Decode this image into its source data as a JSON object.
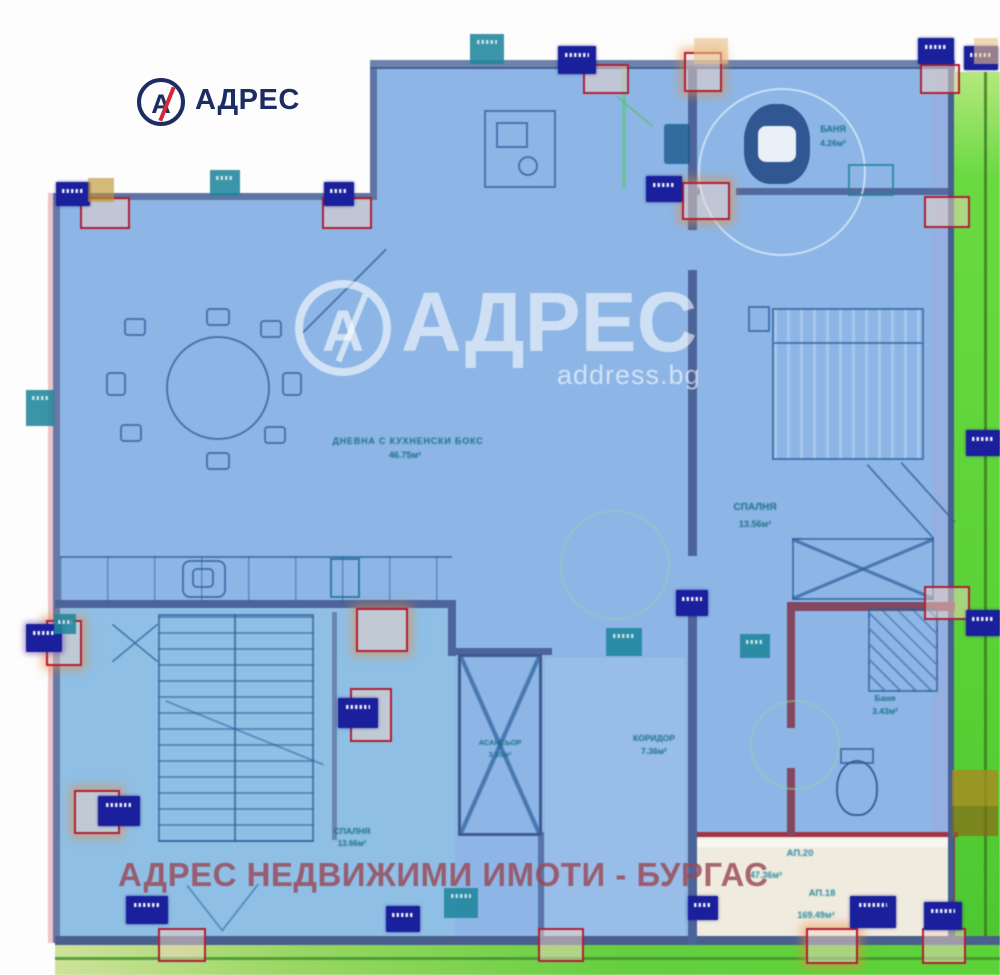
{
  "branding": {
    "logo": {
      "mark": "А",
      "text": "АДРЕС"
    },
    "watermark": {
      "mark": "А",
      "title": "АДРЕС",
      "site": "address.bg"
    },
    "footer_watermark": "АДРЕС НЕДВИЖИМИ ИМОТИ - БУРГАС"
  },
  "floorplan": {
    "rooms": {
      "living": {
        "label": "ДНЕВНА С КУХНЕНСКИ БОКС",
        "area": "46.75м²"
      },
      "bedroom_right": {
        "label": "СПАЛНЯ",
        "area": "13.56м²"
      },
      "bathroom_top": {
        "label": "БАНЯ",
        "area": "4.26м²"
      },
      "corridor": {
        "label": "КОРИДОР",
        "area": "7.36м²"
      },
      "elevator": {
        "label": "АСАНСЬОР",
        "area": "3.20м²"
      },
      "bedroom_left": {
        "label": "СПАЛНЯ",
        "area": "13.66м²"
      },
      "bathroom_bottom": {
        "label": "Баня",
        "area": "3.43м²"
      }
    },
    "apartments": {
      "ap20": {
        "label": "АП.20",
        "area": "47.36м²"
      },
      "ap18": {
        "label": "АП.18",
        "area": "169.49м²"
      }
    },
    "icons": {
      "dining_table": "circle-with-chairs",
      "bed": "striped-rect",
      "toilet": "rounded-blob",
      "shower": "hatched-square",
      "stairs": "stepped-rect",
      "elevator": "x-crossed-rect",
      "sink": "double-ellipse"
    },
    "colors": {
      "fill": "#8db6e6",
      "wall": "#4d649a",
      "column": "#b01f35",
      "marker": "#1a1f9c",
      "label": "#1a7087",
      "terrace_green": "#62d83e",
      "apartment_bg": "#f0ebdf",
      "footer_text": "#984856"
    }
  }
}
